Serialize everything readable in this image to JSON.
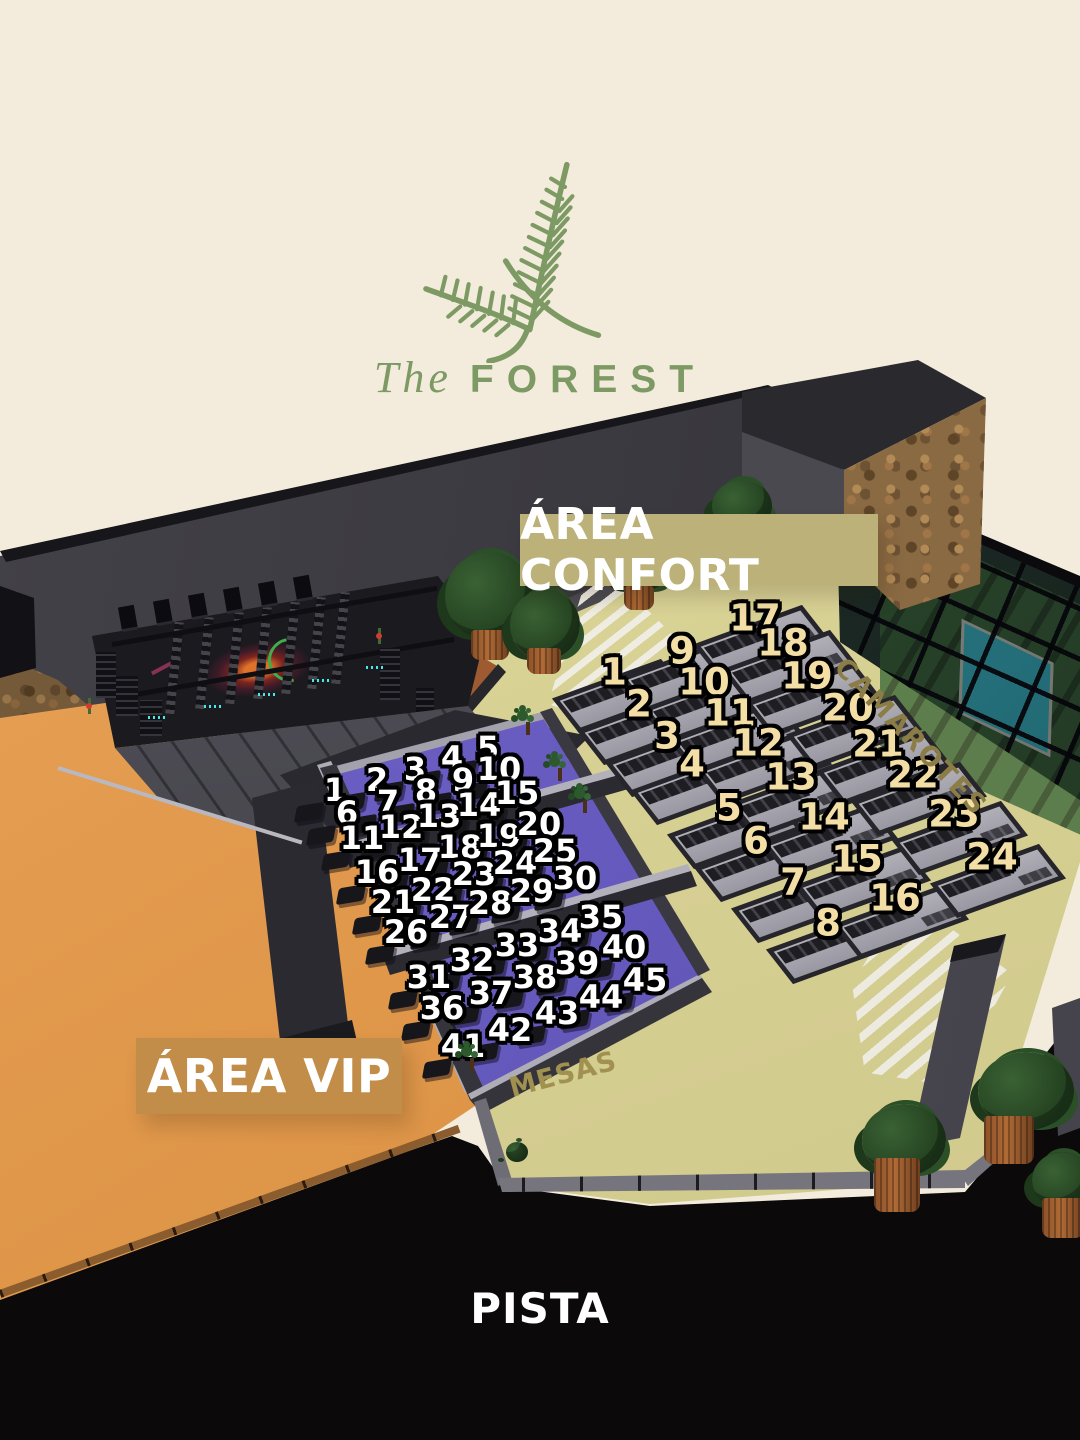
{
  "logo": {
    "the": "The",
    "forest": "FOREST",
    "color": "#7d9a64"
  },
  "labels": {
    "area_confort": "ÁREA CONFORT",
    "area_vip": "ÁREA VIP",
    "camarotes": "CAMAROTES",
    "mesas": "MESAS",
    "pista": "PISTA"
  },
  "colors": {
    "background": "#f3ecdc",
    "logo_green": "#7d9a64",
    "confort_banner": "#bcb179",
    "vip_banner": "#c28c49",
    "confort_number": "#f3dfa5",
    "vip_number": "#ffffff",
    "number_outline": "#000000",
    "beige_floor": "#d9d292",
    "purple_floor": "#6a5ec4",
    "orange_floor": "#e29a4e",
    "pista_floor": "#0a0809",
    "camarotes_text": "#8b7d45",
    "mesas_text": "#a09150",
    "wall_gray": "#3c3b42",
    "pool_blue": "#35b8cf",
    "lawn_green": "#3f6b3b"
  },
  "vip_area": {
    "tables": [
      {
        "n": 1,
        "x": 335,
        "y": 790
      },
      {
        "n": 2,
        "x": 377,
        "y": 780
      },
      {
        "n": 3,
        "x": 415,
        "y": 769
      },
      {
        "n": 4,
        "x": 452,
        "y": 758
      },
      {
        "n": 5,
        "x": 488,
        "y": 748
      },
      {
        "n": 6,
        "x": 347,
        "y": 813
      },
      {
        "n": 7,
        "x": 388,
        "y": 802
      },
      {
        "n": 8,
        "x": 426,
        "y": 791
      },
      {
        "n": 9,
        "x": 463,
        "y": 780
      },
      {
        "n": 10,
        "x": 499,
        "y": 769
      },
      {
        "n": 11,
        "x": 362,
        "y": 838
      },
      {
        "n": 12,
        "x": 401,
        "y": 827
      },
      {
        "n": 13,
        "x": 439,
        "y": 816
      },
      {
        "n": 14,
        "x": 479,
        "y": 805
      },
      {
        "n": 15,
        "x": 517,
        "y": 793
      },
      {
        "n": 16,
        "x": 377,
        "y": 872
      },
      {
        "n": 17,
        "x": 420,
        "y": 860
      },
      {
        "n": 18,
        "x": 460,
        "y": 847
      },
      {
        "n": 19,
        "x": 499,
        "y": 836
      },
      {
        "n": 20,
        "x": 539,
        "y": 824
      },
      {
        "n": 21,
        "x": 393,
        "y": 902
      },
      {
        "n": 22,
        "x": 433,
        "y": 890
      },
      {
        "n": 23,
        "x": 474,
        "y": 874
      },
      {
        "n": 24,
        "x": 515,
        "y": 863
      },
      {
        "n": 25,
        "x": 555,
        "y": 851
      },
      {
        "n": 26,
        "x": 406,
        "y": 932
      },
      {
        "n": 27,
        "x": 451,
        "y": 917
      },
      {
        "n": 28,
        "x": 490,
        "y": 903
      },
      {
        "n": 29,
        "x": 532,
        "y": 891
      },
      {
        "n": 30,
        "x": 575,
        "y": 878
      },
      {
        "n": 31,
        "x": 429,
        "y": 977
      },
      {
        "n": 32,
        "x": 472,
        "y": 960
      },
      {
        "n": 33,
        "x": 517,
        "y": 945
      },
      {
        "n": 34,
        "x": 560,
        "y": 931
      },
      {
        "n": 35,
        "x": 601,
        "y": 917
      },
      {
        "n": 36,
        "x": 442,
        "y": 1008
      },
      {
        "n": 37,
        "x": 491,
        "y": 993
      },
      {
        "n": 38,
        "x": 535,
        "y": 977
      },
      {
        "n": 39,
        "x": 577,
        "y": 963
      },
      {
        "n": 40,
        "x": 624,
        "y": 947
      },
      {
        "n": 41,
        "x": 463,
        "y": 1046
      },
      {
        "n": 42,
        "x": 510,
        "y": 1030
      },
      {
        "n": 43,
        "x": 557,
        "y": 1013
      },
      {
        "n": 44,
        "x": 601,
        "y": 997
      },
      {
        "n": 45,
        "x": 645,
        "y": 980
      }
    ]
  },
  "confort_area": {
    "tables": [
      {
        "n": 1,
        "x": 614,
        "y": 672
      },
      {
        "n": 2,
        "x": 639,
        "y": 704
      },
      {
        "n": 3,
        "x": 667,
        "y": 736
      },
      {
        "n": 4,
        "x": 692,
        "y": 764
      },
      {
        "n": 5,
        "x": 729,
        "y": 808
      },
      {
        "n": 6,
        "x": 756,
        "y": 841
      },
      {
        "n": 7,
        "x": 793,
        "y": 882
      },
      {
        "n": 8,
        "x": 828,
        "y": 923
      },
      {
        "n": 9,
        "x": 682,
        "y": 651
      },
      {
        "n": 10,
        "x": 704,
        "y": 682
      },
      {
        "n": 11,
        "x": 730,
        "y": 713
      },
      {
        "n": 12,
        "x": 758,
        "y": 743
      },
      {
        "n": 13,
        "x": 791,
        "y": 777
      },
      {
        "n": 14,
        "x": 824,
        "y": 817
      },
      {
        "n": 15,
        "x": 857,
        "y": 859
      },
      {
        "n": 16,
        "x": 895,
        "y": 898
      },
      {
        "n": 17,
        "x": 755,
        "y": 618
      },
      {
        "n": 18,
        "x": 783,
        "y": 643
      },
      {
        "n": 19,
        "x": 807,
        "y": 676
      },
      {
        "n": 20,
        "x": 848,
        "y": 708
      },
      {
        "n": 21,
        "x": 878,
        "y": 744
      },
      {
        "n": 22,
        "x": 913,
        "y": 775
      },
      {
        "n": 23,
        "x": 954,
        "y": 814
      },
      {
        "n": 24,
        "x": 992,
        "y": 857
      }
    ]
  }
}
